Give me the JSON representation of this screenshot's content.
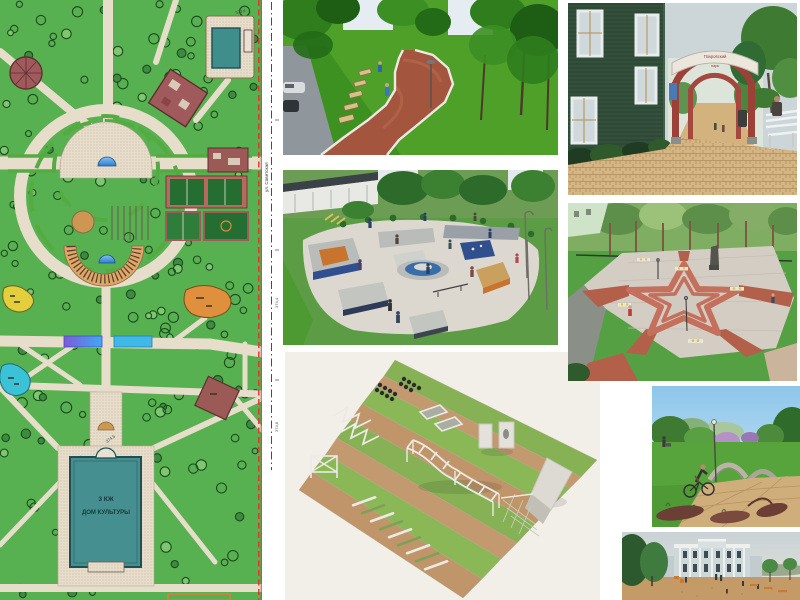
{
  "page": {
    "background": "#ffffff"
  },
  "plan": {
    "culture_house": {
      "line1": "3 КЖ",
      "line2": "ДОМ КУЛЬТУРЫ"
    },
    "street_label": "ул. Советская",
    "elevations": {
      "e1": "573,4",
      "e2": "374,6",
      "e3": "374,8"
    },
    "margin_marks": {
      "m1": "374,8",
      "m2": "374,4"
    },
    "colors": {
      "lawn": "#58b150",
      "path": "#e6ddcb",
      "building": "#a05a5c",
      "pool": "#3f8e8b",
      "water": "#2f7fd1",
      "playground_yellow": "#e3cf3e",
      "playground_orange": "#e0903c",
      "playground_cyan": "#3cc2d6",
      "court_green": "#256e31",
      "boundary_red": "#e0312f",
      "culture_house_teal": "#458f90"
    }
  },
  "arch": {
    "sign_line1": "Покровский",
    "sign_line2": "парк"
  },
  "tiles": [
    {
      "id": "master-plan"
    },
    {
      "id": "walkway-render"
    },
    {
      "id": "skatepark-render"
    },
    {
      "id": "workout-course-render"
    },
    {
      "id": "entrance-arch-render"
    },
    {
      "id": "star-plaza-render"
    },
    {
      "id": "bike-path-render"
    },
    {
      "id": "culture-house-square-render"
    }
  ]
}
